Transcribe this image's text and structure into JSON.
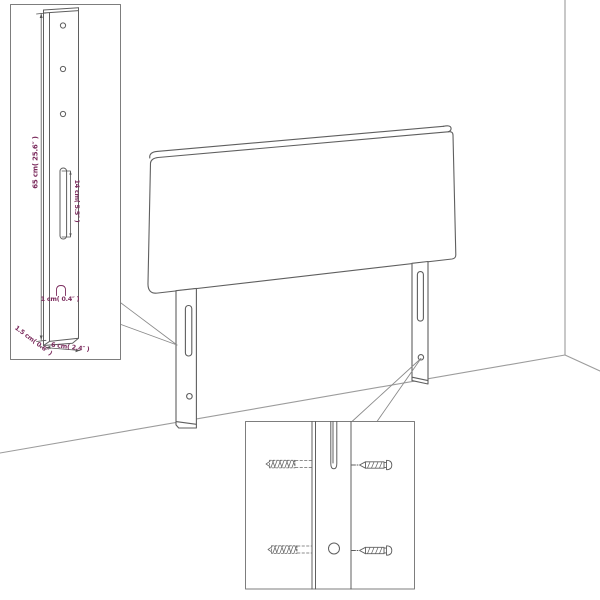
{
  "diagram": {
    "kind": "headboard-assembly-diagram",
    "colors": {
      "background": "#ffffff",
      "line_art": "#5f5f5f",
      "room_lines": "#9c9c9c",
      "dimension_text": "#7b2b5d",
      "dimension_lines": "#555555"
    },
    "leg_detail_inset": {
      "height_label": "65 cm( 25.6″ )",
      "slot_height_label": "14 cm( 5.5″ )",
      "thickness_label": "1 cm( 0.4″ )",
      "depth_label": "1.5 cm( 0.6″ )",
      "width_label": "6 cm( 2.4″ )",
      "hole_count": 3
    },
    "screw_detail_inset": {
      "screw_count": 4
    }
  }
}
